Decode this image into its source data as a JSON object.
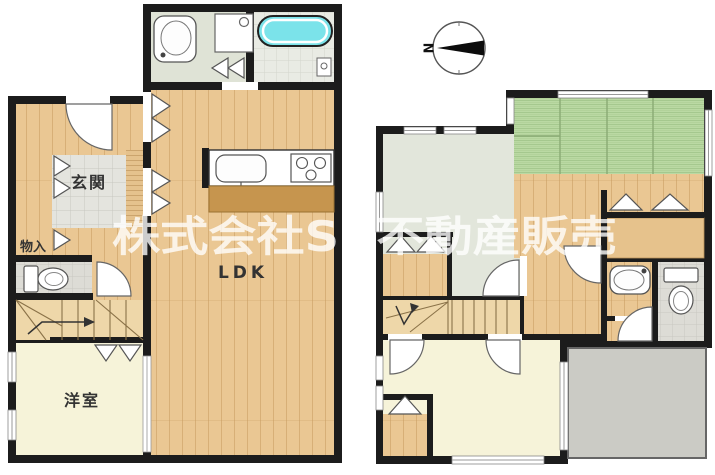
{
  "watermark_text": "株式会社SR不動産販売",
  "compass": {
    "north_label": "N"
  },
  "floor1": {
    "entrance": "玄関",
    "storage": "物入",
    "ldk": "LDK",
    "western_room": "洋室"
  },
  "colors": {
    "wall": "#1c1c1c",
    "wood_floor": "#eac793",
    "tatami_green": "#bad9a3",
    "bathtub_cyan": "#7be3ea",
    "western_room_cream": "#f6f3d9",
    "gray_room": "#e2e6db",
    "entrance_tile": "#e4e4de",
    "balcony_gray": "#cbcbc5",
    "kitchen_counter_wood": "#c6954e",
    "stair_wood": "#eed7a9",
    "watermark_white": "rgba(255,255,255,0.78)"
  }
}
